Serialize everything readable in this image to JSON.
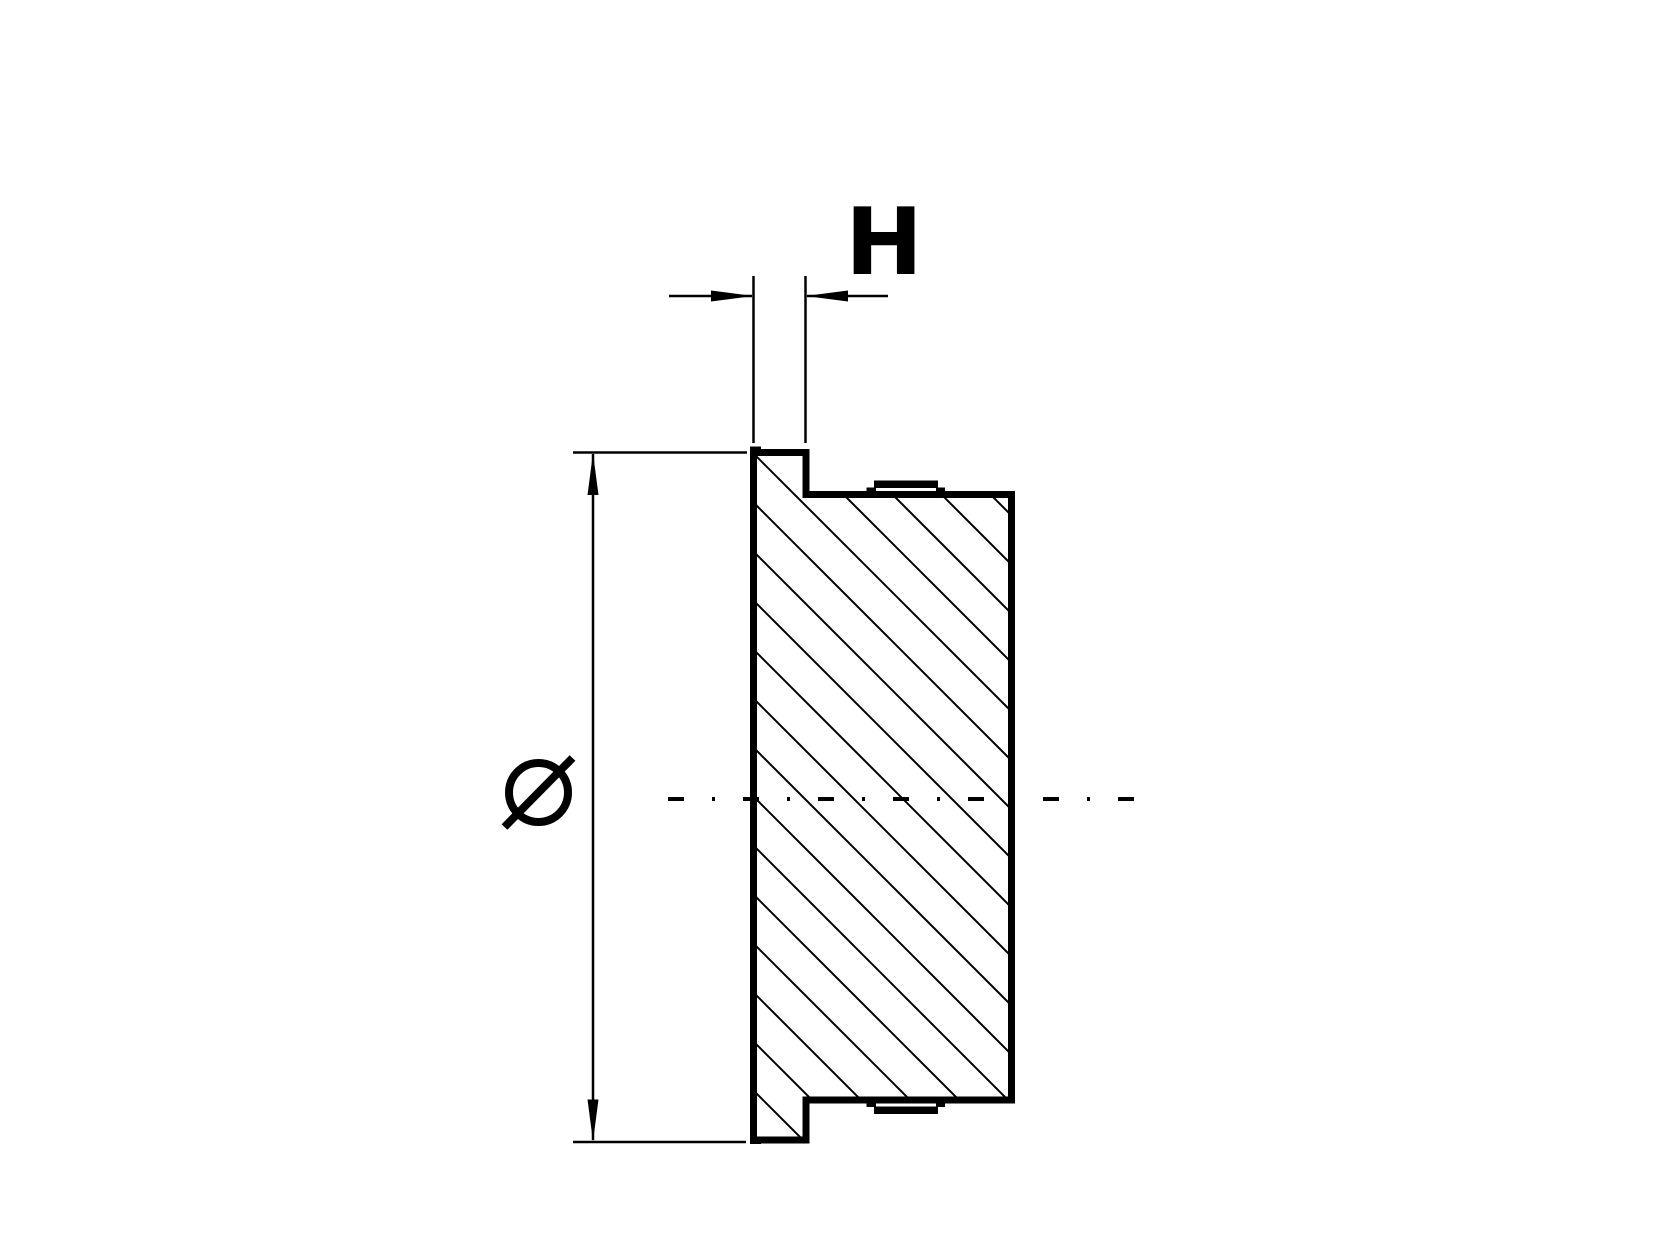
{
  "drawing": {
    "view": "cross-section",
    "colors": {
      "line": "#000000",
      "background": "#ffffff"
    },
    "labels": {
      "height_dimension": "H",
      "diameter_dimension": "Ø"
    },
    "style": {
      "outline_stroke_px": 7,
      "thin_stroke_px": 2.5,
      "centerline_stroke_px": 4
    },
    "hatch": {
      "angle_deg": 45,
      "spacing_px": 49,
      "c_start": -545,
      "c_end": 386,
      "stroke_px": 2
    }
  }
}
